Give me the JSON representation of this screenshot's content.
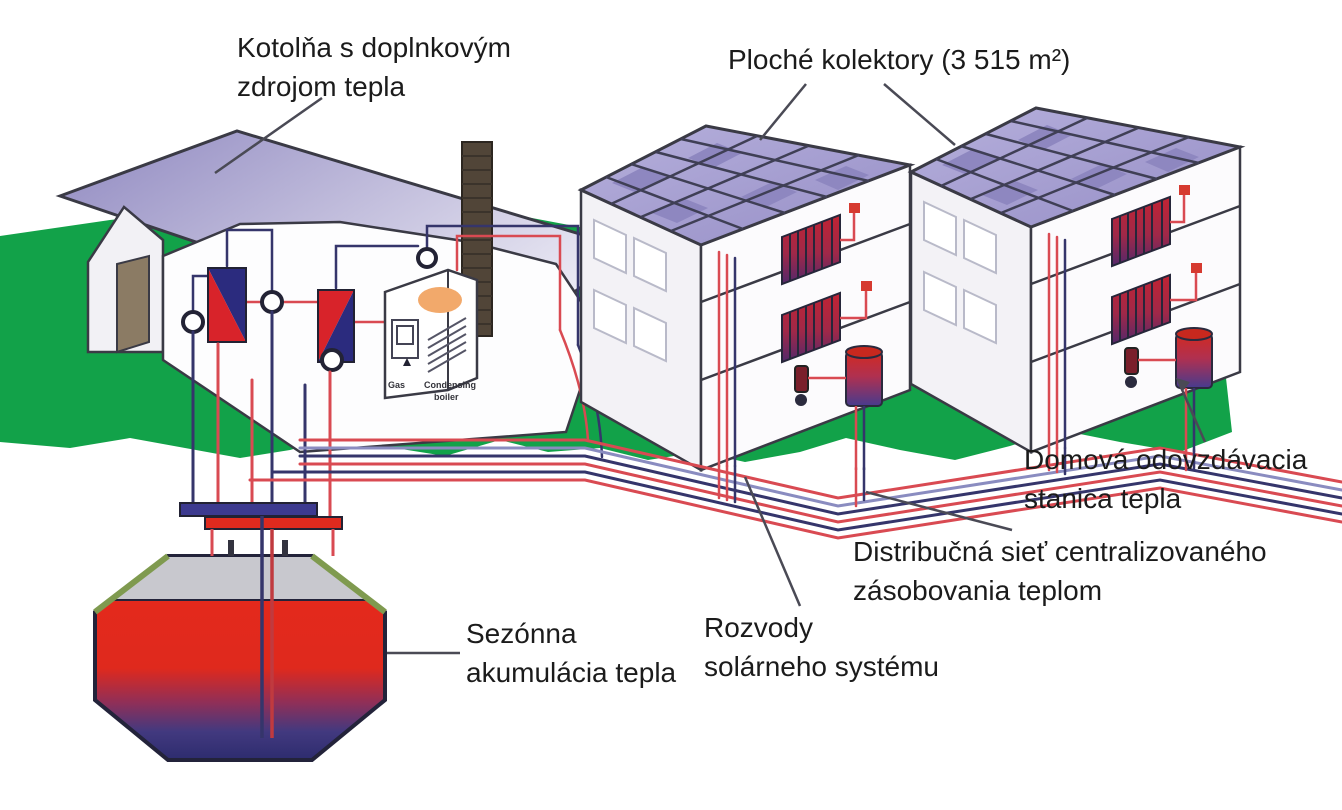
{
  "figure": {
    "type": "diagram",
    "subject": "central-solar-district-heating-system",
    "annotations": [
      {
        "id": "kotolna",
        "lines": [
          "Kotolňa s doplnkovým",
          "zdrojom tepla"
        ]
      },
      {
        "id": "kolektory",
        "lines": [
          "Ploché kolektory (3 515 m²)"
        ]
      },
      {
        "id": "domova",
        "lines": [
          "Domová odovzdávacia",
          "stanica tepla"
        ]
      },
      {
        "id": "distribucna",
        "lines": [
          "Distribučná sieť centralizovaného",
          "zásobovania teplom"
        ]
      },
      {
        "id": "rozvody",
        "lines": [
          "Rozvody",
          "solárneho systému"
        ]
      },
      {
        "id": "sezonna",
        "lines": [
          "Sezónna",
          "akumulácia tepla"
        ]
      }
    ],
    "equipment_labels": {
      "gas": "Gas",
      "condensing_1": "Condensing",
      "condensing_2": "boiler"
    },
    "colors": {
      "ground_green": "#12A249",
      "collector_panel": "#A7A0CE",
      "roof_slab": "#9D96C5",
      "pipe_hot_red": "#D94A52",
      "pipe_cold_blue": "#8A8CC0",
      "pipe_dark_navy": "#35356B",
      "storage_hot": "#E62A1D",
      "storage_cold": "#2D2C70",
      "outline": "#3A3A45"
    }
  }
}
